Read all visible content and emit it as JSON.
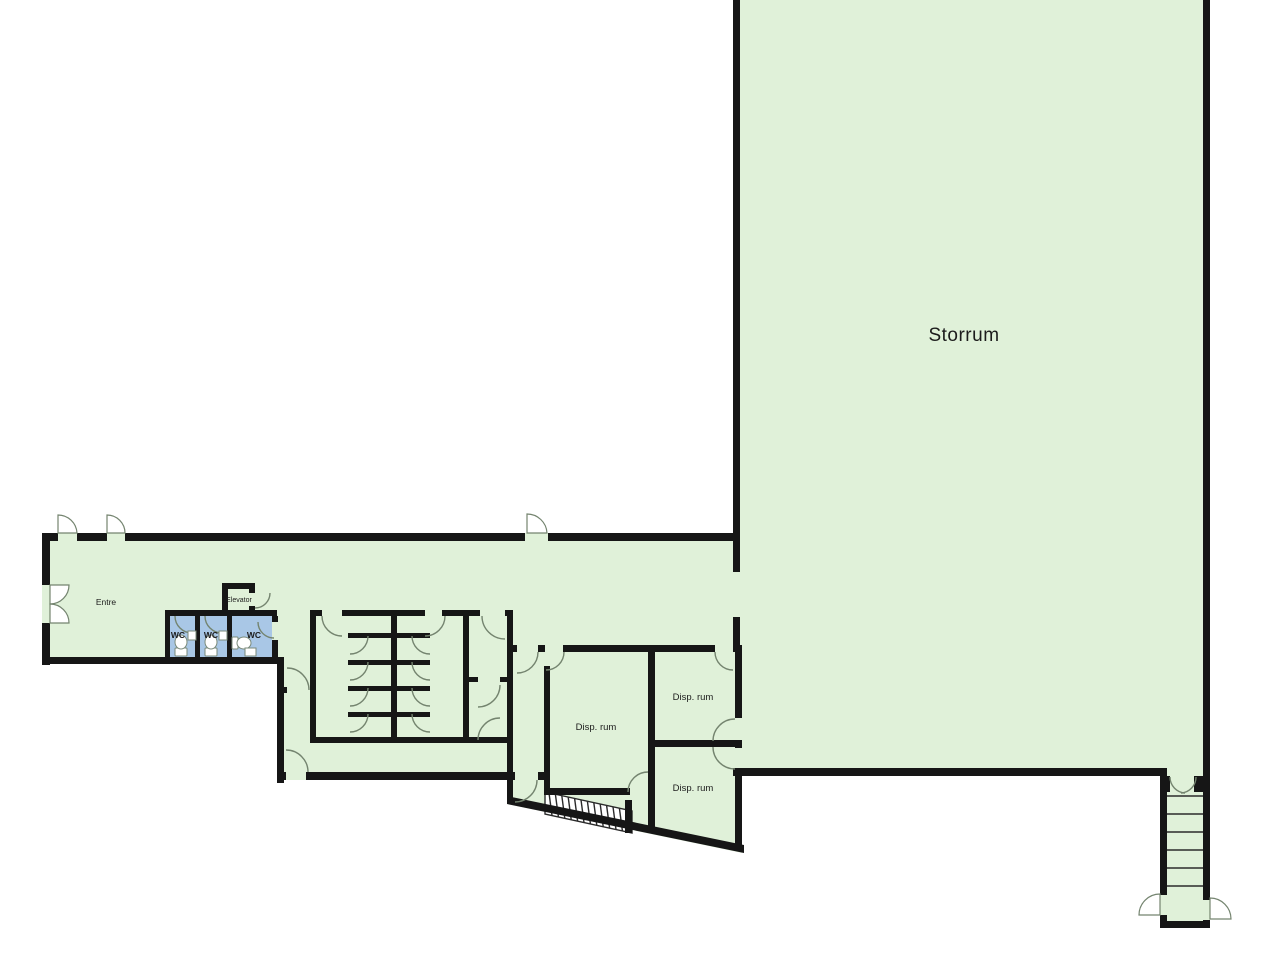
{
  "floorplan": {
    "rooms": {
      "storrum": {
        "label": "Storrum"
      },
      "entre": {
        "label": "Entre"
      },
      "elevator": {
        "label": "Elevator"
      },
      "wc_left": {
        "label": "WC"
      },
      "wc_middle": {
        "label": "WC"
      },
      "wc_right": {
        "label": "WC"
      },
      "disp_rum_main": {
        "label": "Disp. rum"
      },
      "disp_rum_upper": {
        "label": "Disp. rum"
      },
      "disp_rum_lower": {
        "label": "Disp. rum"
      }
    },
    "colors": {
      "background": "#ffffff",
      "floor": "#e0f1d9",
      "wc_floor": "#a9c7e6",
      "wall": "#161616",
      "door_line": "#74846f",
      "fixture_fill": "#ffffff",
      "label_text": "#1c1c1c"
    }
  }
}
